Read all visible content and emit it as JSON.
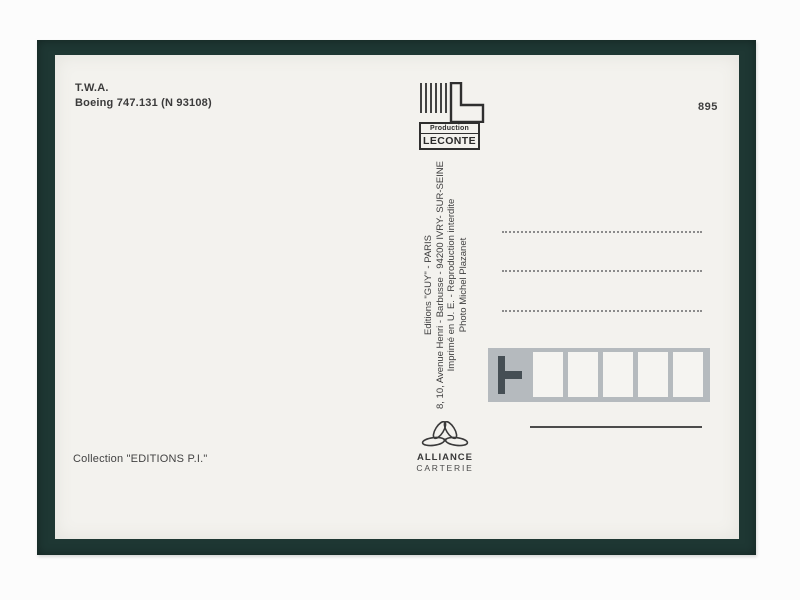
{
  "postcard": {
    "caption": {
      "line1": "T.W.A.",
      "line2": "Boeing 747.131 (N 93108)"
    },
    "card_number": "895",
    "leconte_logo": {
      "label_top": "Production",
      "label_bottom": "LECONTE"
    },
    "credits": {
      "line1": "Editions \"GUY\" - PARIS",
      "line2": "8, 10, Avenue Henri - Barbusse - 94200 IVRY- SUR-SEINE",
      "line3": "Imprimé en U. E. - Reproduction interdite",
      "line4": "Photo Michel Plazanet"
    },
    "alliance_logo": {
      "name": "ALLIANCE",
      "type": "CARTERIE"
    },
    "collection": "Collection \"EDITIONS P.I.\"",
    "colors": {
      "border_green": "#1e3733",
      "card_paper": "#f3f2ee",
      "postal_gray": "#b5babe",
      "ink": "#3b3b3b"
    }
  }
}
